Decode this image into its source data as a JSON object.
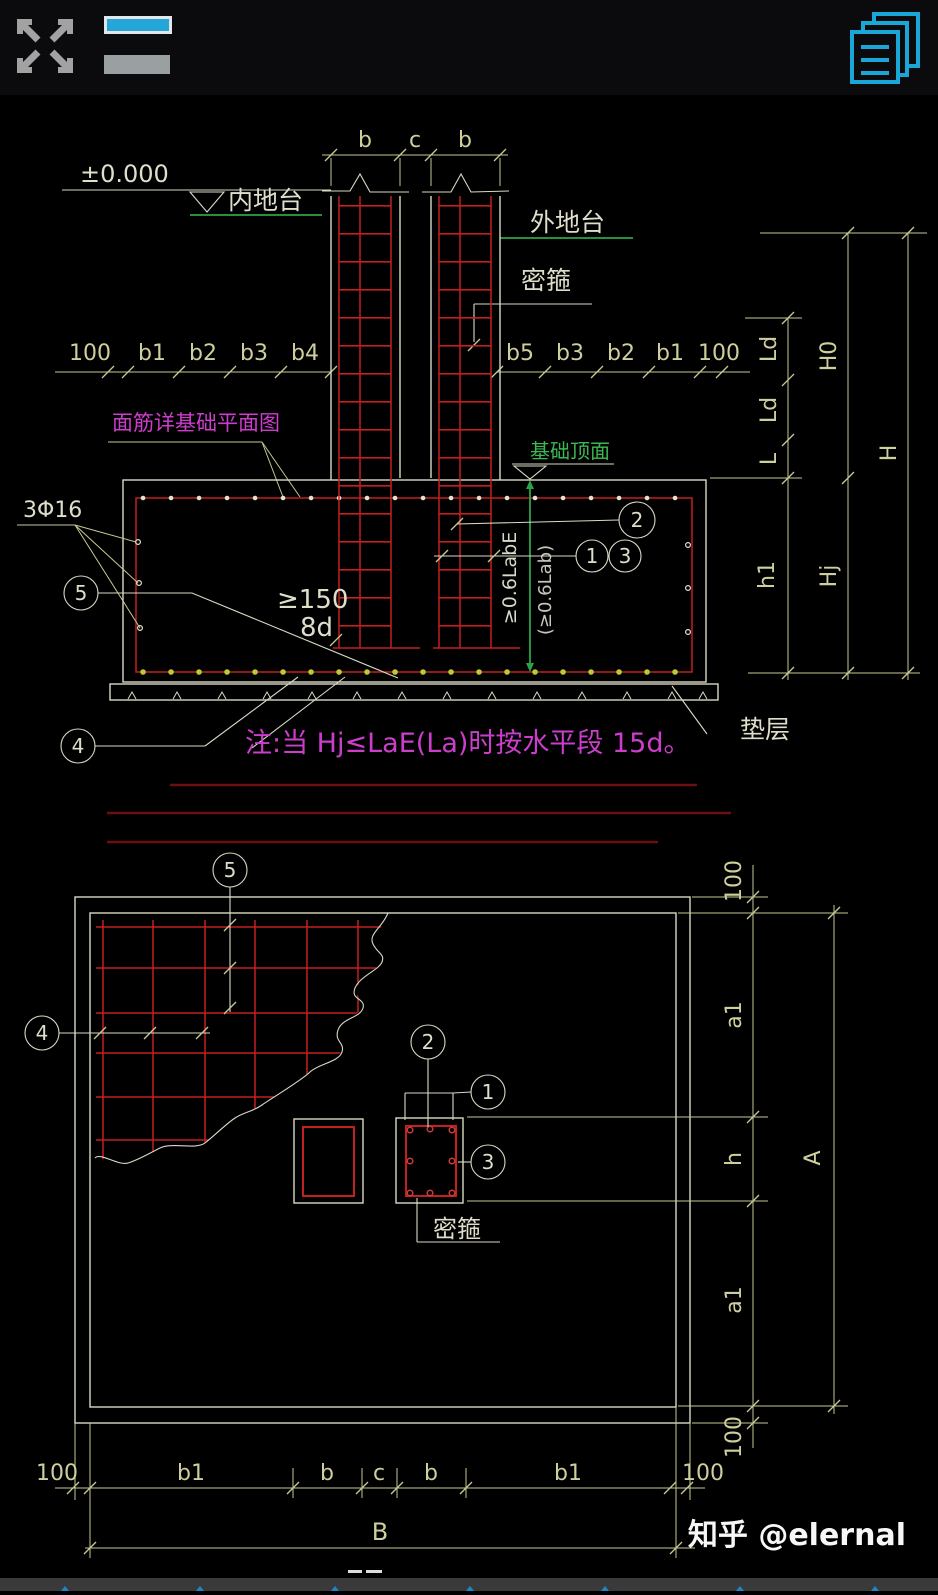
{
  "toolbar": {
    "fullscreen_icon": "expand-arrows-icon",
    "layers_icon": "layer-bars-icon",
    "drawings_icon": "stacked-pages-icon"
  },
  "section": {
    "dim_top": [
      "b",
      "c",
      "b"
    ],
    "level": "±0.000",
    "inner_ground": "内地台",
    "outer_ground": "外地台",
    "stirrup": "密箍",
    "dims_left": [
      "100",
      "b1",
      "b2",
      "b3",
      "b4"
    ],
    "dims_right": [
      "b5",
      "b3",
      "b2",
      "b1",
      "100"
    ],
    "top_note": "面筋详基础平面图",
    "found_top": "基础顶面",
    "vdims": {
      "ld1": "Ld",
      "ld2": "Ld",
      "l": "L",
      "h1": "h1",
      "h0": "H0",
      "hj": "Hj",
      "h": "H"
    },
    "bars": "3Φ16",
    "min150": "≥150",
    "hook8d": "8d",
    "anchor_e": "≥0.6LabE",
    "anchor_b": "(≥0.6Lab)",
    "note": "注:当 Hj≤LaE(La)时按水平段 15d。",
    "cushion": "垫层"
  },
  "callouts": {
    "n1": "1",
    "n2": "2",
    "n3": "3",
    "n4": "4",
    "n5": "5"
  },
  "plan": {
    "stirrup": "密箍",
    "vdims": [
      "100",
      "a1",
      "h",
      "a1",
      "100"
    ],
    "vtotal": "A",
    "hdims": [
      "100",
      "b1",
      "b",
      "c",
      "b",
      "b1",
      "100"
    ],
    "htotal": "B"
  },
  "watermark": {
    "text": "知乎 @elernal"
  },
  "colors": {
    "cad_red": "#c32020",
    "cad_dark_red": "#6d0f0f",
    "cad_green": "#2ba447",
    "cad_magenta": "#cb3ecb",
    "cad_dim_yellow": "#c9c994",
    "cad_cyan": "#1aa6d6",
    "dot_yellow": "#b8cc33"
  }
}
